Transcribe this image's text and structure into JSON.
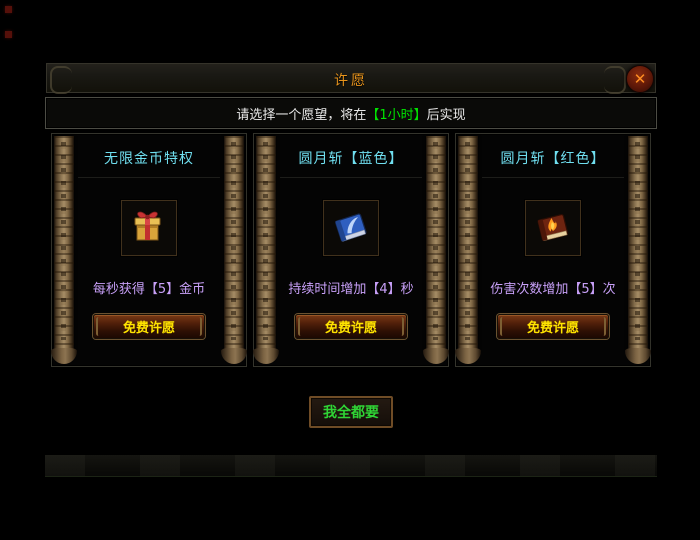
{
  "window": {
    "title": "许愿"
  },
  "close_button": {
    "glyph": "✕"
  },
  "subtitle": {
    "prefix": "请选择一个愿望，将在",
    "highlight": "【1小时】",
    "suffix": "后实现"
  },
  "panels": [
    {
      "header": "无限金币特权",
      "icon": "gift-box-icon",
      "desc": "每秒获得【5】金币",
      "button_label": "免费许愿"
    },
    {
      "header": "圆月斩【蓝色】",
      "icon": "blue-book-icon",
      "desc": "持续时间增加【4】秒",
      "button_label": "免费许愿"
    },
    {
      "header": "圆月斩【红色】",
      "icon": "fire-book-icon",
      "desc": "伤害次数增加【5】次",
      "button_label": "免费许愿"
    }
  ],
  "footer": {
    "take_all_label": "我全都要"
  },
  "colors": {
    "title": "#e8941c",
    "panel_header": "#70dff0",
    "subtitle_highlight": "#00e400",
    "description": "#c8a0f8",
    "wish_button_text": "#ffe400",
    "take_all_text": "#2fd435"
  }
}
